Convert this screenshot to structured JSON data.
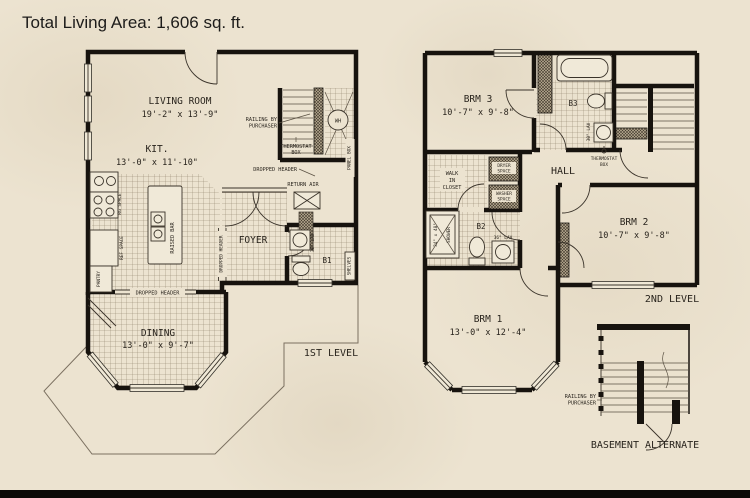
{
  "title": "Total Living Area: 1,606 sq. ft.",
  "colors": {
    "background": "#ece3d0",
    "wall": "#17130e",
    "text": "#29241d"
  },
  "first_level": {
    "caption": "1ST LEVEL",
    "living_room_name": "LIVING ROOM",
    "living_room_dims": "19'-2\" x 13'-9\"",
    "kitchen_name": "KIT.",
    "kitchen_dims": "13'-0\" x 11'-10\"",
    "dining_name": "DINING",
    "dining_dims": "13'-0\" x 9'-7\"",
    "foyer_name": "FOYER",
    "bath1_name": "B1",
    "railing_line1": "RAILING BY",
    "railing_line2": "PURCHASER",
    "thermostat_line1": "THERMOSTAT",
    "thermostat_line2": "BOX",
    "dropped_header": "DROPPED HEADER",
    "return_air": "RETURN AIR",
    "panel_box": "PANEL BOX",
    "water_heater": "WH",
    "range_space": "RG SPACE",
    "ref_space": "REF SPACE",
    "pantry": "PANTRY",
    "raised_bar": "RAISED BAR",
    "lav": "30\" LAV",
    "shelves": "SHELVES"
  },
  "second_level": {
    "caption": "2ND LEVEL",
    "bedroom3_name": "BRM 3",
    "bedroom3_dims": "10'-7\" x 9'-8\"",
    "bedroom2_name": "BRM 2",
    "bedroom2_dims": "10'-7\" x 9'-8\"",
    "bedroom1_name": "BRM 1",
    "bedroom1_dims": "13'-0\" x 12'-4\"",
    "hall_name": "HALL",
    "bath3_name": "B3",
    "bath2_name": "B2",
    "bath3_lav": "30\" LAV",
    "bath2_lav": "36\" LAV",
    "shower_size": "34\" x 48\"",
    "shower": "SHOWER",
    "closet_line1": "WALK",
    "closet_line2": "IN",
    "closet_line3": "CLOSET",
    "dryer_line1": "DRYER",
    "dryer_line2": "SPACE",
    "washer_line1": "WASHER",
    "washer_line2": "SPACE",
    "thermostat_line1": "THERMOSTAT",
    "thermostat_line2": "BOX"
  },
  "basement": {
    "caption": "BASEMENT ALTERNATE",
    "railing_line1": "RAILING BY",
    "railing_line2": "PURCHASER"
  }
}
